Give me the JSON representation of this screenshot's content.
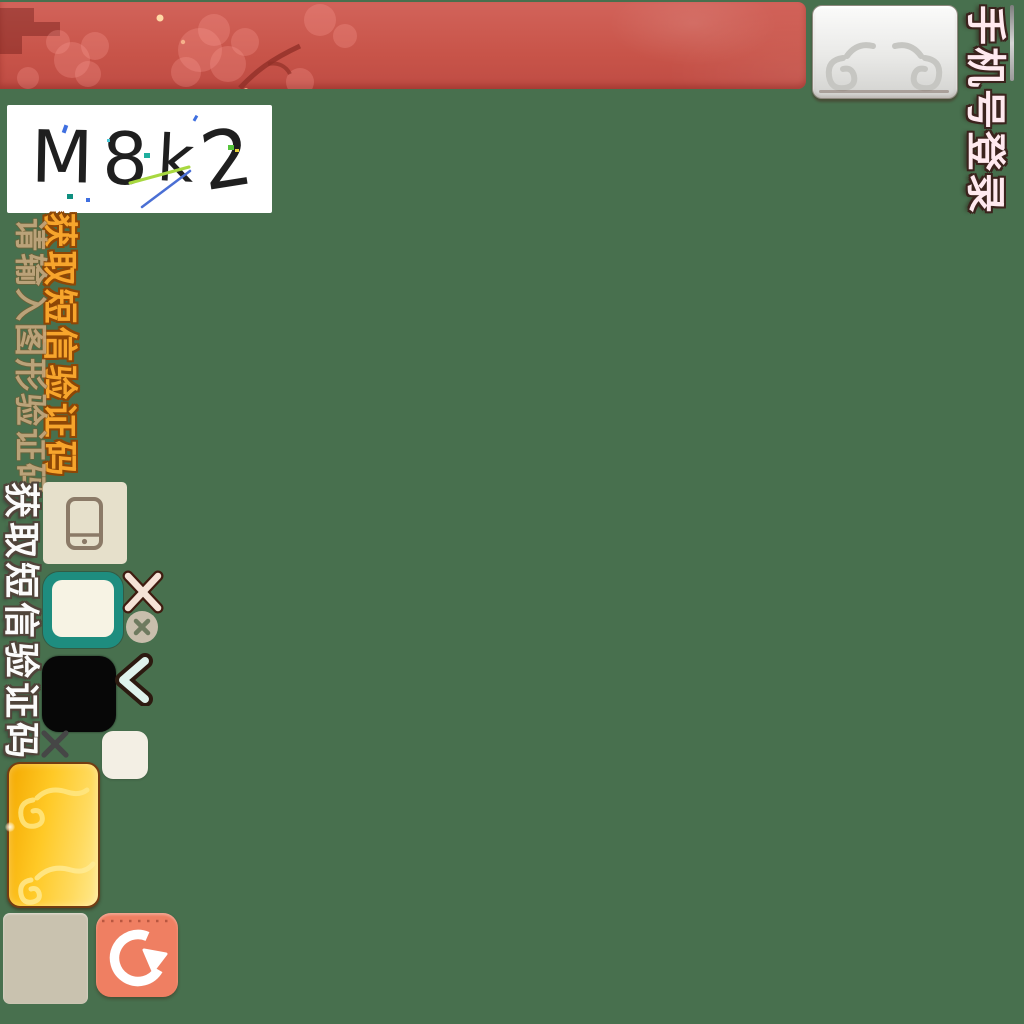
{
  "app": {
    "title_vertical": "手机号登录"
  },
  "captcha": {
    "code": "M8k2",
    "placeholder": "请输入图形验证码"
  },
  "buttons": {
    "get_sms_primary": "获取短信验证码",
    "get_sms_secondary": "获取短信验证码"
  },
  "icons": {
    "phone": "phone-icon",
    "refresh": "refresh-icon",
    "close_large": "close-icon",
    "close_small": "close-icon-small",
    "clear": "clear-circle-icon",
    "chevron": "chevron-left-icon",
    "cloud": "cloud-decoration",
    "blossom": "blossom-decoration"
  },
  "colors": {
    "bg": "#48704e",
    "banner-red": "#c85449",
    "silver": "#e9e9e7",
    "gold": "#ffc926",
    "teal": "#1e8d7f",
    "salmon": "#ef7f62",
    "beige": "#e6e0cb",
    "tan": "#c9c2af",
    "cream": "#f3efe4",
    "black-box": "#070707",
    "sms-orange": "#f7a52c",
    "title-pink": "#ffe9ef"
  }
}
